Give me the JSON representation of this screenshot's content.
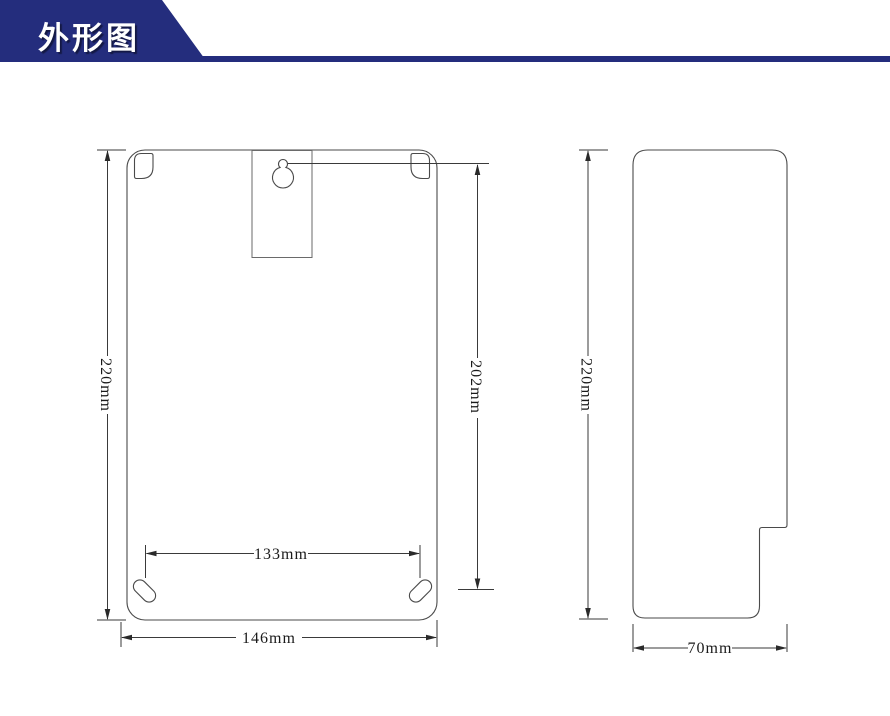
{
  "header": {
    "title": "外形图"
  },
  "colors": {
    "accent": "#242d7d",
    "outline": "#4a4a4a",
    "dimension_line": "#3a3a3a",
    "dimension_text": "#1a1a1a"
  },
  "front_view": {
    "height_label": "220mm",
    "keyhole_offset_label": "202mm",
    "hole_spacing_label": "133mm",
    "width_label": "146mm"
  },
  "side_view": {
    "height_label": "220mm",
    "depth_label": "70mm"
  }
}
